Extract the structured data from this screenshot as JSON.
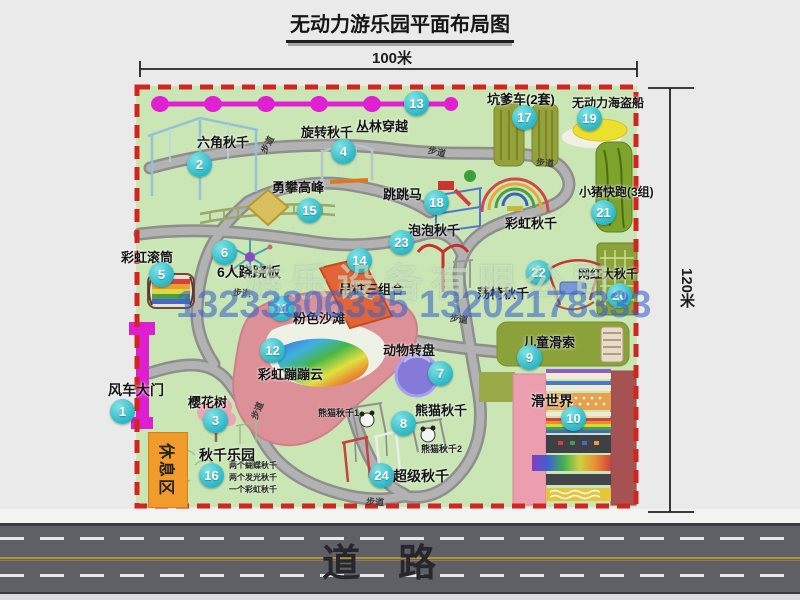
{
  "title": "无动力游乐园平面布局图",
  "dimensions": {
    "width": "100米",
    "height": "120米"
  },
  "road_label": "道　路",
  "watermark": {
    "company": "游乐设备有限公司",
    "phone": "13233806335 13202178333"
  },
  "rest_area_label": "休息区",
  "walkway_label": "步道",
  "rainbow_swing_label": "彩虹秋千",
  "panda_sub_labels": [
    "熊猫秋千1",
    "熊猫秋千2"
  ],
  "swing_park_details": [
    "两个蝴蝶秋千",
    "两个发光秋千",
    "一个彩虹秋千"
  ],
  "attractions": [
    {
      "num": "1",
      "name": "风车大门"
    },
    {
      "num": "2",
      "name": "六角秋千"
    },
    {
      "num": "3",
      "name": "樱花树"
    },
    {
      "num": "4",
      "name": "旋转秋千"
    },
    {
      "num": "5",
      "name": "彩虹滚筒"
    },
    {
      "num": "6",
      "name": "6人跷跷板"
    },
    {
      "num": "7",
      "name": "动物转盘"
    },
    {
      "num": "8",
      "name": "熊猫秋千"
    },
    {
      "num": "9",
      "name": "儿童滑索"
    },
    {
      "num": "10",
      "name": "滑世界"
    },
    {
      "num": "11",
      "name": "粉色沙滩"
    },
    {
      "num": "12",
      "name": "彩虹蹦蹦云"
    },
    {
      "num": "13",
      "name": "丛林穿越"
    },
    {
      "num": "14",
      "name": "吊桩三组合"
    },
    {
      "num": "15",
      "name": "勇攀高峰"
    },
    {
      "num": "16",
      "name": "秋千乐园"
    },
    {
      "num": "17",
      "name": "坑爹车(2套)"
    },
    {
      "num": "18",
      "name": "跳跳马"
    },
    {
      "num": "19",
      "name": "无动力海盗船"
    },
    {
      "num": "20",
      "name": "网红大秋千"
    },
    {
      "num": "21",
      "name": "小猪快跑(3组)"
    },
    {
      "num": "22",
      "name": "荡椅秋千"
    },
    {
      "num": "23",
      "name": "泡泡秋千"
    },
    {
      "num": "24",
      "name": "超级秋千"
    }
  ],
  "colors": {
    "map_green": "#c9e6b4",
    "border_red": "#d2251f",
    "badge_teal": "#29b7c5",
    "gate_magenta": "#de1fd0",
    "road_gray": "#5f5f66",
    "rest_orange": "#f19b2d"
  }
}
